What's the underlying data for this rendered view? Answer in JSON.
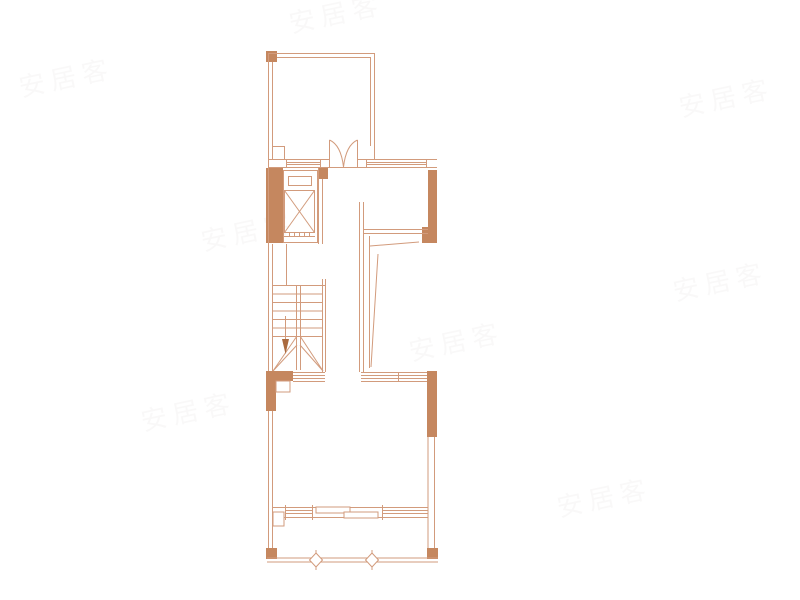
{
  "palette": {
    "background": "#ffffff",
    "line": "#d29b7c",
    "wall_fill": "#c5875f",
    "arrow_fill": "#aa6a3e",
    "watermark_color": "#9a948f"
  },
  "watermark": {
    "text": "安居客"
  },
  "floorplan": {
    "symbols": [
      {
        "name": "double-swing-door",
        "shape": "two quarter arcs meeting at center"
      },
      {
        "name": "elevator",
        "shape": "rectangle with X diagonals"
      },
      {
        "name": "staircase",
        "shape": "treads with center rail and winder V lines"
      },
      {
        "name": "stair-direction-arrow",
        "shape": "down-pointing filled arrow"
      },
      {
        "name": "window",
        "shape": "parallel triple/quad lines in wall"
      },
      {
        "name": "sliding-door",
        "shape": "two offset panel rectangles"
      },
      {
        "name": "drain-symbol",
        "shape": "small outlined diamond on wall line"
      },
      {
        "name": "structural-wall",
        "shape": "solid terracotta filled block"
      }
    ]
  }
}
